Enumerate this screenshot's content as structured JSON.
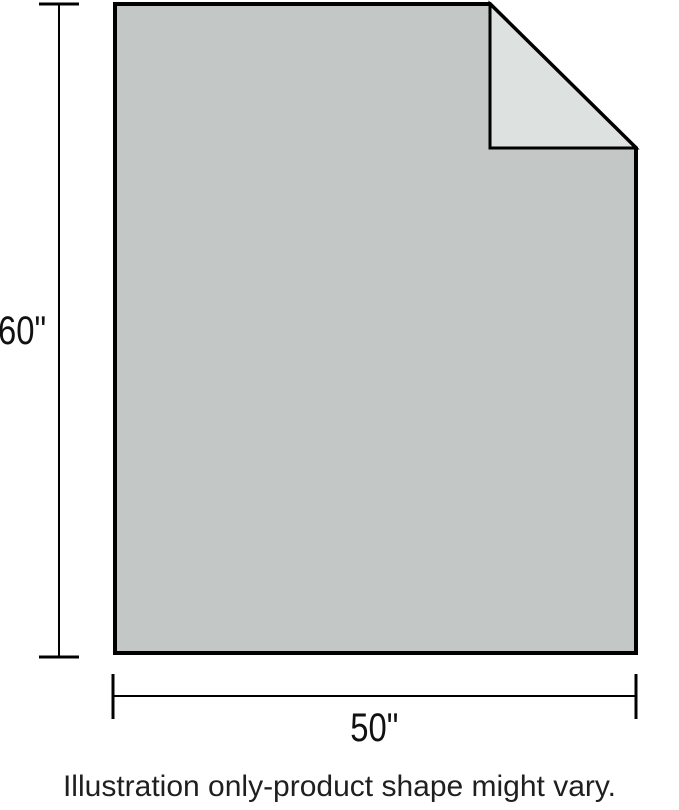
{
  "illustration": {
    "body_color": "#c3c8c7",
    "fold_color": "#dde1e0",
    "outline_color": "#000000",
    "height_label": "60\"",
    "width_label": "50\""
  },
  "caption": "Illustration only-product shape might vary."
}
